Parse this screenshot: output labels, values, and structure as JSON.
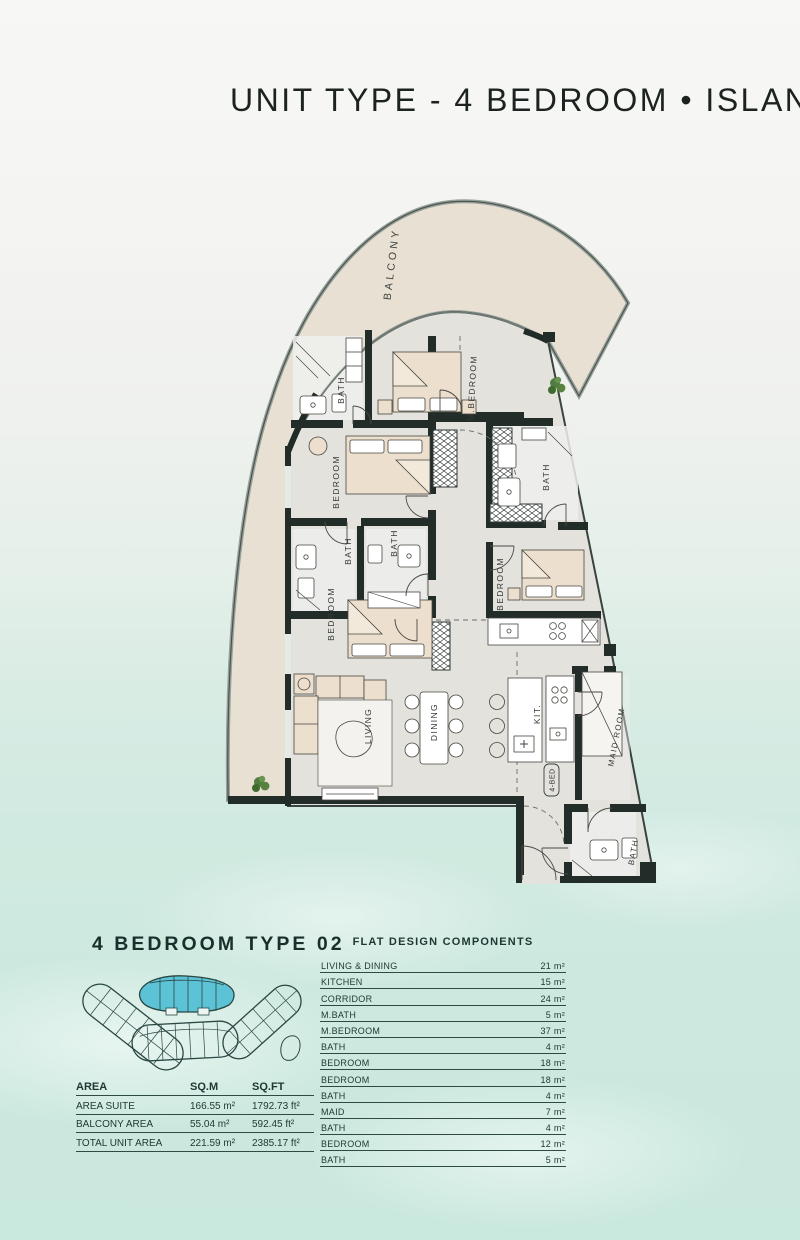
{
  "title": "UNIT TYPE - 4 BEDROOM • ISLAND",
  "plan": {
    "balcony": "BALCONY",
    "m_bedroom": "M.BEDROOM",
    "m_bath": "BATH",
    "bedroom_upper": "BEDROOM",
    "bath_mid_left": "BATH",
    "bath_mid_right": "BATH",
    "bedroom_lower": "BEDROOM",
    "bath_right": "BATH",
    "bedroom_right": "BEDROOM",
    "living": "LIVING",
    "dining": "DINING",
    "kitchen": "KIT.",
    "maid_room": "MAID ROOM",
    "bath_bottom": "BATH",
    "unit_tag": "4-BED"
  },
  "key_plan": {
    "heading": "4 BEDROOM TYPE 02"
  },
  "area_table": {
    "headers": [
      "AREA",
      "SQ.M",
      "SQ.FT"
    ],
    "rows": [
      {
        "label": "AREA SUITE",
        "sqm": "166.55 m²",
        "sqft": "1792.73 ft²"
      },
      {
        "label": "BALCONY AREA",
        "sqm": "55.04 m²",
        "sqft": "592.45 ft²"
      },
      {
        "label": "TOTAL UNIT AREA",
        "sqm": "221.59 m²",
        "sqft": "2385.17 ft²"
      }
    ]
  },
  "components_table": {
    "title": "FLAT DESIGN COMPONENTS",
    "rows": [
      {
        "label": "LIVING & DINING",
        "value": "21 m²"
      },
      {
        "label": "KITCHEN",
        "value": "15 m²"
      },
      {
        "label": "CORRIDOR",
        "value": "24 m²"
      },
      {
        "label": "M.BATH",
        "value": "5 m²"
      },
      {
        "label": "M.BEDROOM",
        "value": "37 m²"
      },
      {
        "label": "BATH",
        "value": "4 m²"
      },
      {
        "label": "BEDROOM",
        "value": "18 m²"
      },
      {
        "label": "BEDROOM",
        "value": "18 m²"
      },
      {
        "label": "BATH",
        "value": "4 m²"
      },
      {
        "label": "MAID",
        "value": "7 m²"
      },
      {
        "label": "BATH",
        "value": "4 m²"
      },
      {
        "label": "BEDROOM",
        "value": "12 m²"
      },
      {
        "label": "BATH",
        "value": "5 m²"
      }
    ]
  },
  "colors": {
    "accent_cyan": "#5cc3d6",
    "wall": "#222d2a",
    "balcony_floor": "#e7e0d3",
    "unit_floor": "#e4e2dd",
    "text_dark": "#1d3732"
  }
}
